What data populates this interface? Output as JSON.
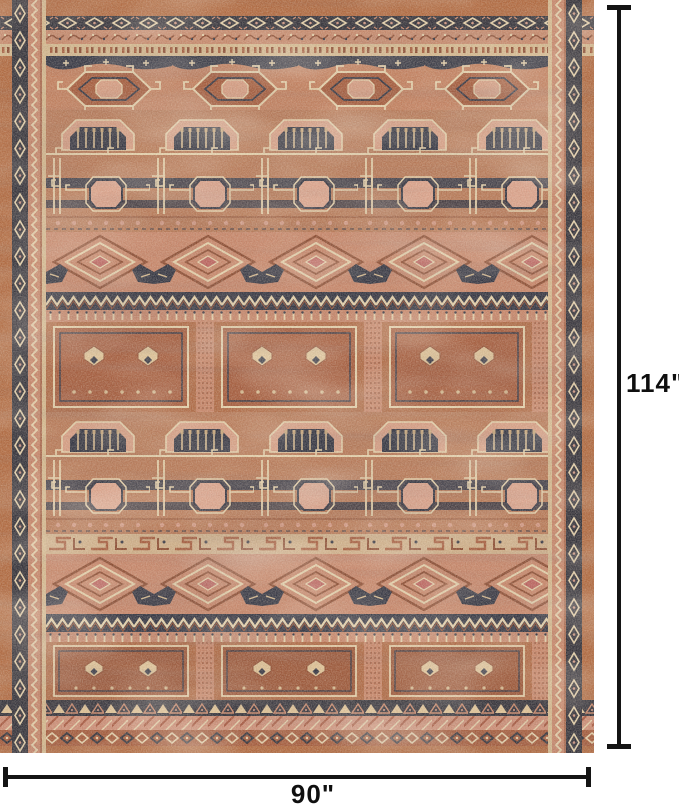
{
  "image": {
    "description": "Product dimension image: distressed vintage-style tribal area rug in terracotta, blush, navy and cream, shown with height and width dimension lines",
    "background_color": "#ffffff"
  },
  "rug": {
    "pattern": "vintage tribal geometric with hexagon medallions, arch and tassel motifs, greek-key pillars, octagons, concentric diamonds, zigzag bands and square panels",
    "palette": {
      "salmon": "#c9876b",
      "terracotta": "#b06a45",
      "rust": "#a55a3b",
      "navy": "#2b3040",
      "cream": "#e8d6b0",
      "blush": "#d9a086"
    }
  },
  "dimensions": {
    "height_label": "114\"",
    "width_label": "90\"",
    "line_color": "#141414"
  }
}
